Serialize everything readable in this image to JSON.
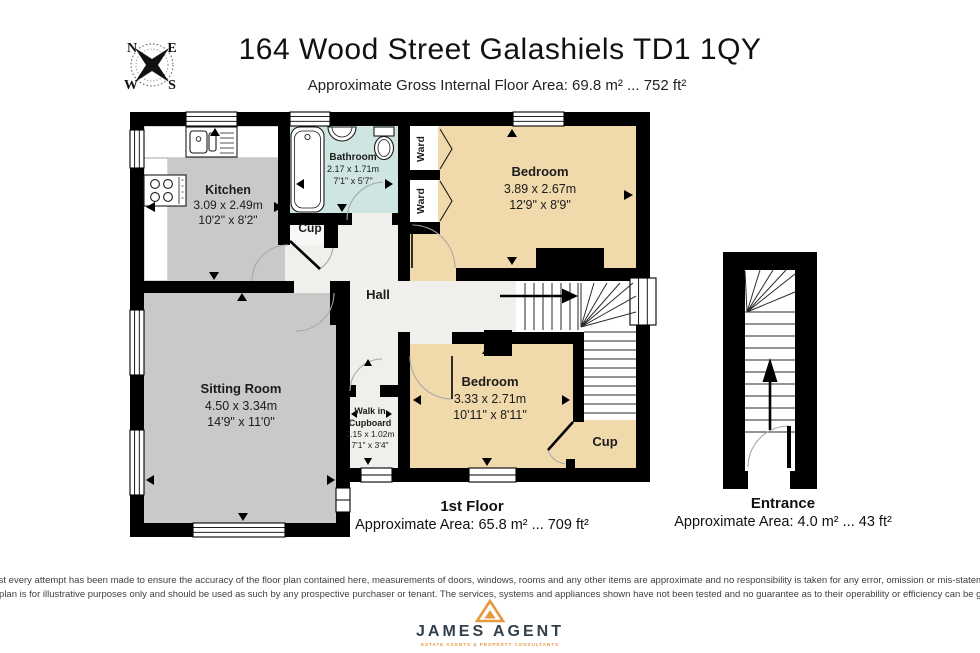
{
  "header": {
    "title": "164 Wood Street Galashiels TD1 1QY",
    "subtitle": "Approximate Gross Internal Floor Area: 69.8 m² ... 752 ft²",
    "compass": {
      "n": "N",
      "e": "E",
      "w": "W",
      "s": "S"
    }
  },
  "rooms": {
    "kitchen": {
      "name": "Kitchen",
      "metric": "3.09 x 2.49m",
      "imperial": "10'2\" x 8'2\""
    },
    "bathroom": {
      "name": "Bathroom",
      "metric": "2.17 x 1.71m",
      "imperial": "7'1\" x 5'7\""
    },
    "bedroom1": {
      "name": "Bedroom",
      "metric": "3.89 x 2.67m",
      "imperial": "12'9\" x 8'9\""
    },
    "bedroom2": {
      "name": "Bedroom",
      "metric": "3.33 x 2.71m",
      "imperial": "10'11\" x 8'11\""
    },
    "sitting": {
      "name": "Sitting Room",
      "metric": "4.50 x 3.34m",
      "imperial": "14'9\" x 11'0\""
    },
    "walkin": {
      "name_line1": "Walk in",
      "name_line2": "Cupboard",
      "metric": "2.15 x 1.02m",
      "imperial": "7'1\" x 3'4\""
    },
    "hall": {
      "name": "Hall"
    },
    "cup": {
      "name": "Cup"
    },
    "ward": {
      "name": "Ward"
    }
  },
  "floor_summary": {
    "label": "1st Floor",
    "area": "Approximate Area: 65.8 m² ... 709 ft²"
  },
  "entrance_summary": {
    "label": "Entrance",
    "area": "Approximate Area: 4.0 m² ... 43 ft²"
  },
  "disclaimer": {
    "line1": "Whilst every attempt has been made to ensure the accuracy of the floor plan contained here, measurements of doors, windows, rooms and any other items are approximate and no responsibility is taken for any error, omission or mis-statement.",
    "line2": "This plan is for illustrative purposes only and should be used as such by any prospective purchaser or tenant. The services, systems and appliances shown have not been tested and no guarantee as to their operability or efficiency can be given."
  },
  "logo": {
    "name": "JAMES AGENT",
    "tagline": "ESTATE AGENTS & PROPERTY CONSULTANTS"
  },
  "colors": {
    "wall": "#000000",
    "room_gray": "#c9c9c9",
    "bedroom_beige": "#f0d9ab",
    "bathroom_blue": "#cfe5e2",
    "hall_floor": "#f0efec",
    "logo_navy": "#33404e",
    "logo_orange": "#e8983c"
  }
}
